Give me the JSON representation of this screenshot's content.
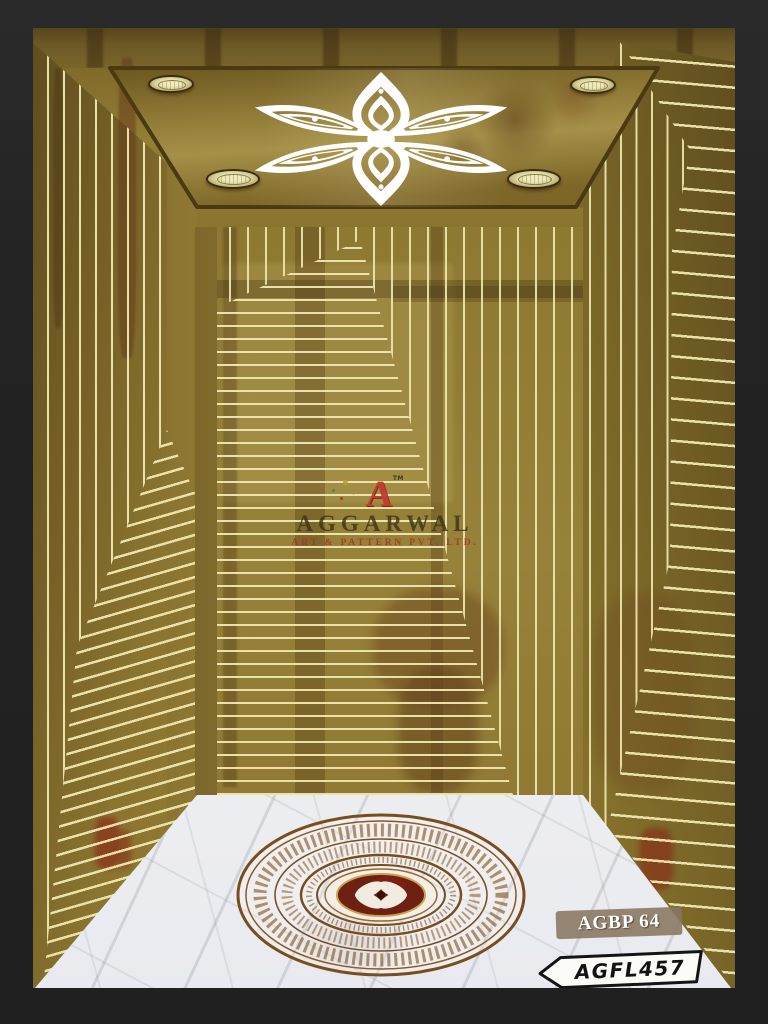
{
  "artwork": {
    "title": "Gold elevator cabin interior design render",
    "brand": {
      "logo_letter": "A",
      "trademark": "TM",
      "name": "AGGARWAL",
      "subtitle": "ART & PATTERN PVT. LTD."
    },
    "codes": {
      "wall_panel": "AGBP 64",
      "floor_panel": "AGFL457"
    },
    "colors": {
      "frame": "#242424",
      "gold_mid": "#97823a",
      "gold_dark": "#6e5a24",
      "etch_line": "#ece4ac",
      "marble": "#f3f3f5",
      "medallion_bronze": "#7a4d1d",
      "medallion_center": "#6e2012",
      "logo_red": "#c13a2c",
      "label_box": "#887660"
    }
  }
}
